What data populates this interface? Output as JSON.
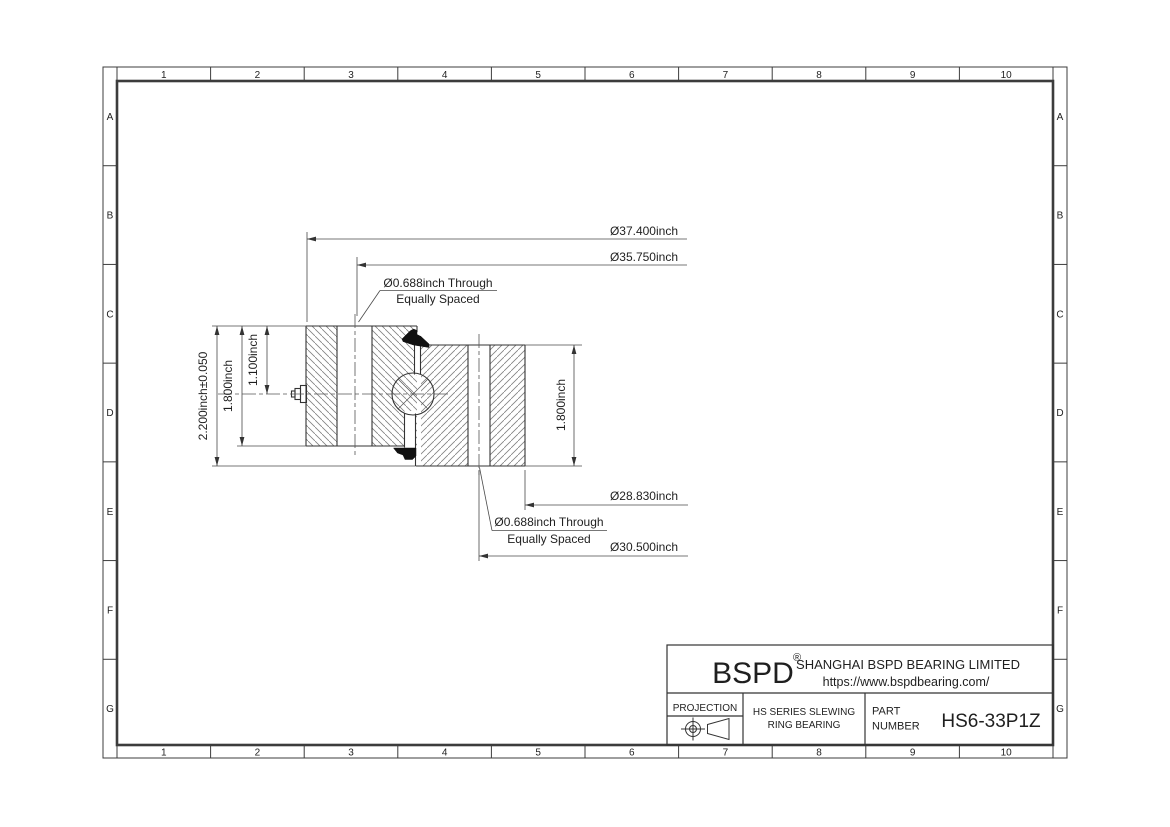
{
  "grid": {
    "columns": [
      "1",
      "2",
      "3",
      "4",
      "5",
      "6",
      "7",
      "8",
      "9",
      "10"
    ],
    "rows": [
      "A",
      "B",
      "C",
      "D",
      "E",
      "F",
      "G"
    ]
  },
  "dimensions": {
    "outer_diameter": "Ø37.400inch",
    "outer_bolt_circle": "Ø35.750inch",
    "top_hole_note_line1": "Ø0.688inch Through",
    "top_hole_note_line2": "Equally Spaced",
    "inner_diameter": "Ø28.830inch",
    "inner_bolt_circle": "Ø30.500inch",
    "bottom_hole_note_line1": "Ø0.688inch Through",
    "bottom_hole_note_line2": "Equally Spaced",
    "overall_height": "2.200inch±0.050",
    "outer_ring_height": "1.800inch",
    "grease_fitting_height": "1.100inch",
    "inner_ring_height": "1.800inch"
  },
  "title_block": {
    "logo": "BSPD",
    "registered_mark": "®",
    "company": "SHANGHAI BSPD BEARING LIMITED",
    "website": "https://www.bspdbearing.com/",
    "projection_label": "PROJECTION",
    "series_line1": "HS SERIES SLEWING",
    "series_line2": "RING BEARING",
    "part_label_line1": "PART",
    "part_label_line2": "NUMBER",
    "part_number": "HS6-33P1Z"
  },
  "colors": {
    "line": "#333333",
    "hatch": "#818181",
    "seal": "#111111",
    "background": "#ffffff"
  }
}
